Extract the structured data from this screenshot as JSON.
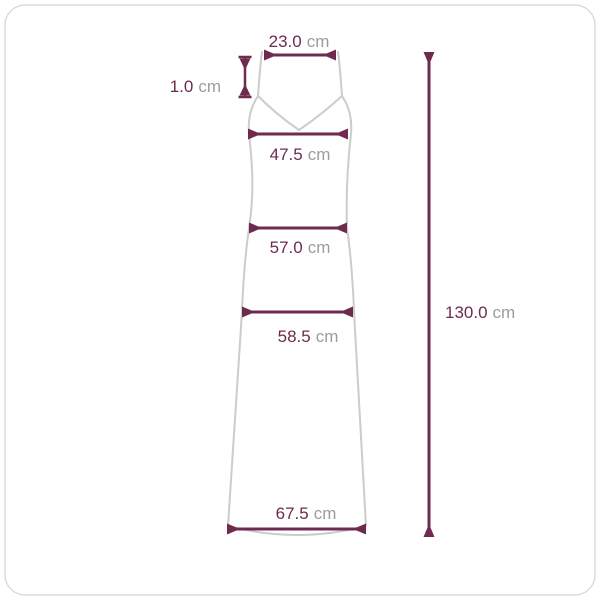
{
  "colors": {
    "accent": "#6e2b4d",
    "outline": "#cccccc",
    "unit_text": "#9c9c9c",
    "frame_border": "#dcdcdc",
    "background": "#ffffff"
  },
  "diagram": {
    "kind": "garment-size-measurement-diagram",
    "garment": "sleeveless-v-neck-maxi-dress",
    "measurements": {
      "shoulder": {
        "value": "23.0",
        "unit": "cm"
      },
      "strap": {
        "value": "1.0",
        "unit": "cm"
      },
      "bust": {
        "value": "47.5",
        "unit": "cm"
      },
      "waist": {
        "value": "57.0",
        "unit": "cm"
      },
      "hip": {
        "value": "58.5",
        "unit": "cm"
      },
      "hem": {
        "value": "67.5",
        "unit": "cm"
      },
      "length": {
        "value": "130.0",
        "unit": "cm"
      }
    }
  }
}
